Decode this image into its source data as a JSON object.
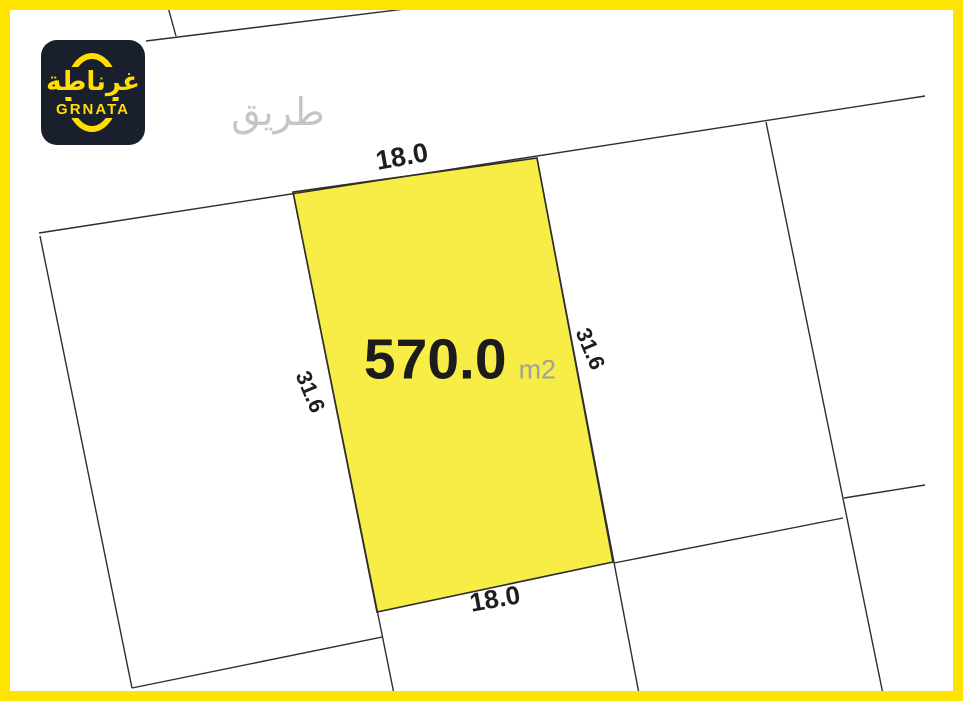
{
  "colors": {
    "frame": "#FFE400",
    "plot_fill": "#F8EC46",
    "line": "#2E2E2E",
    "road_text": "#C5C5C5",
    "area_text": "#1C1C1C",
    "unit_text": "#A0A0A0",
    "dim_text": "#1E1E1E",
    "logo_bg": "#191F2C",
    "logo_accent": "#FFDE00"
  },
  "logo": {
    "arabic": "غرناطة",
    "latin": "GRNATA"
  },
  "road": {
    "label": "طريق"
  },
  "plot": {
    "area": "570.0",
    "unit": "m2",
    "top_width": "18.0",
    "bottom_width": "18.0",
    "left_depth": "31.6",
    "right_depth": "31.6"
  }
}
